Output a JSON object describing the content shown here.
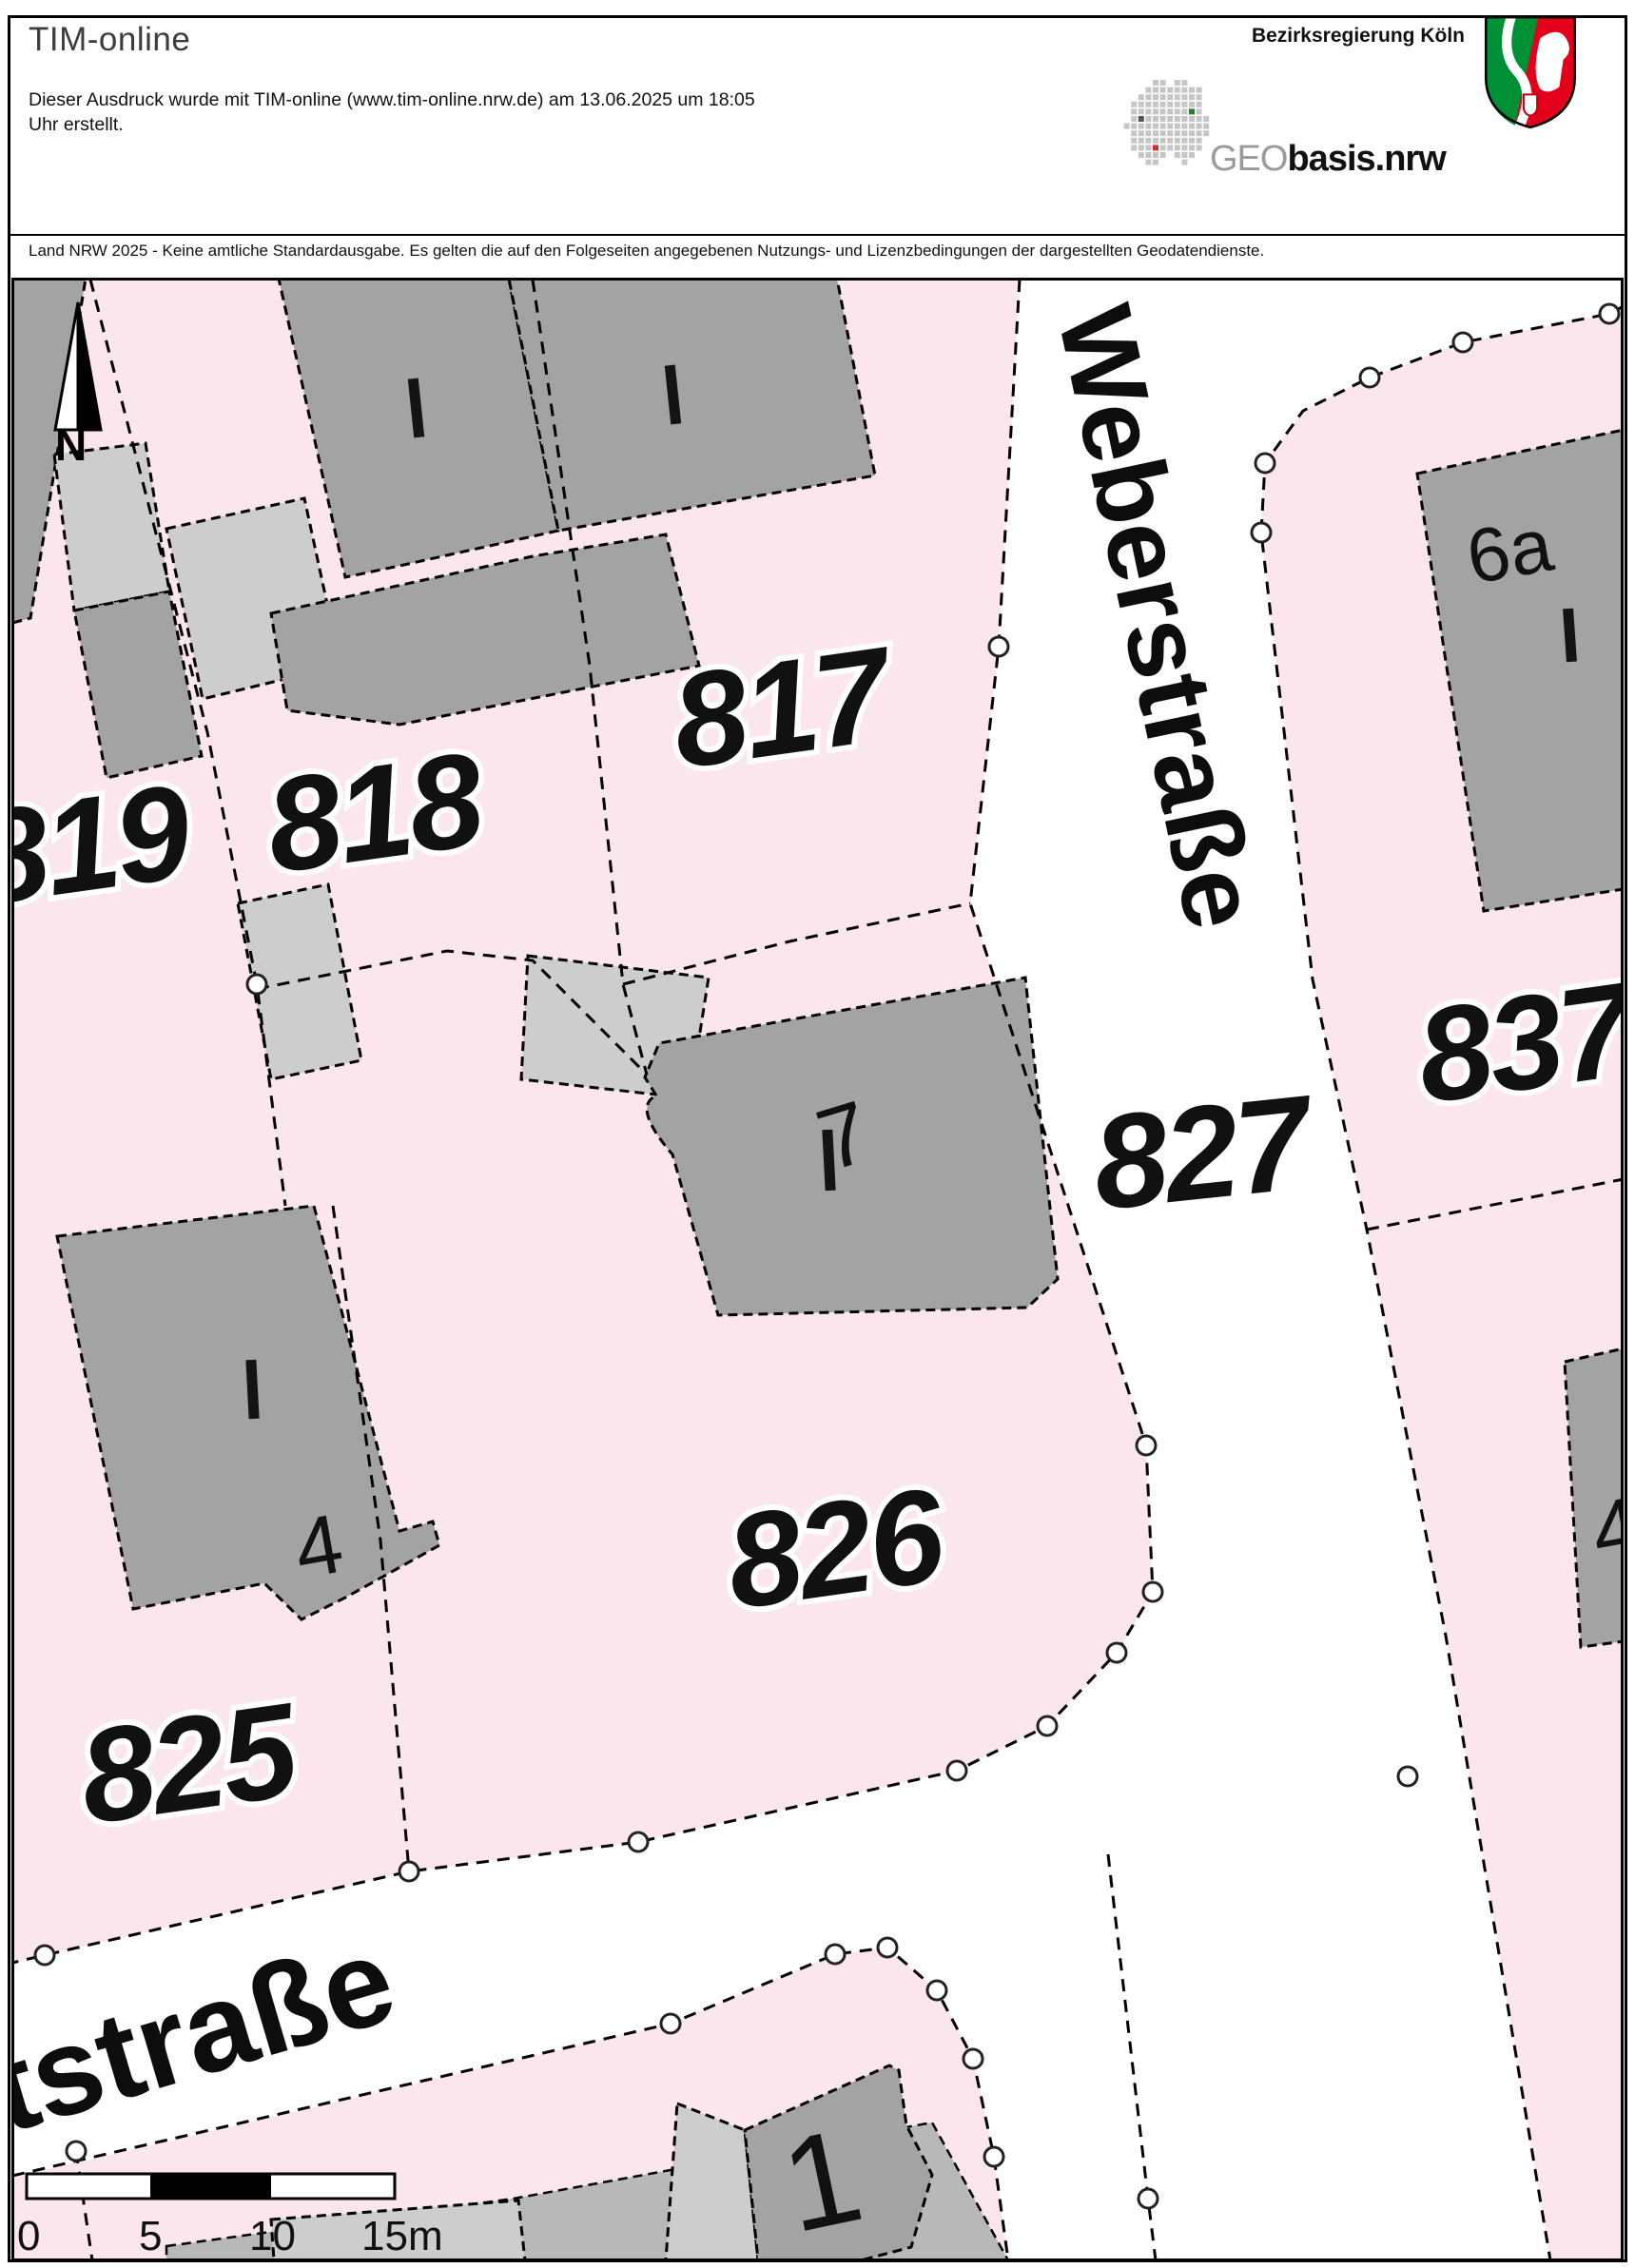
{
  "header": {
    "title": "TIM-online",
    "info_line1": "Dieser Ausdruck wurde mit TIM-online (www.tim-online.nrw.de) am 13.06.2025 um 18:05",
    "info_line2": "Uhr erstellt.",
    "agency": "Bezirksregierung Köln",
    "logo_geo": "GEO",
    "logo_basis": "basis.nrw",
    "disclaimer": "Land NRW 2025 - Keine amtliche Standardausgabe. Es gelten die auf den Folgeseiten angegebenen Nutzungs- und Lizenzbedingungen der dargestellten Geodatendienste."
  },
  "map": {
    "north_label": "N",
    "streets": [
      {
        "name": "Weberstraße"
      },
      {
        "name": "rtstraße"
      }
    ],
    "parcels": [
      {
        "label": "819"
      },
      {
        "label": "818"
      },
      {
        "label": "817"
      },
      {
        "label": "827"
      },
      {
        "label": "837"
      },
      {
        "label": "826"
      },
      {
        "label": "825"
      }
    ],
    "house_numbers": [
      {
        "label": "6a"
      },
      {
        "label": "7"
      },
      {
        "label": "4"
      },
      {
        "label": "4"
      },
      {
        "label": "1"
      }
    ],
    "scale_bar": {
      "labels": [
        "0",
        "5",
        "10",
        "15m"
      ]
    },
    "colors": {
      "parcel": "#fce6ee",
      "building": "#a3a3a3",
      "building_light": "#cdcdcd",
      "street": "#ffffff"
    }
  }
}
